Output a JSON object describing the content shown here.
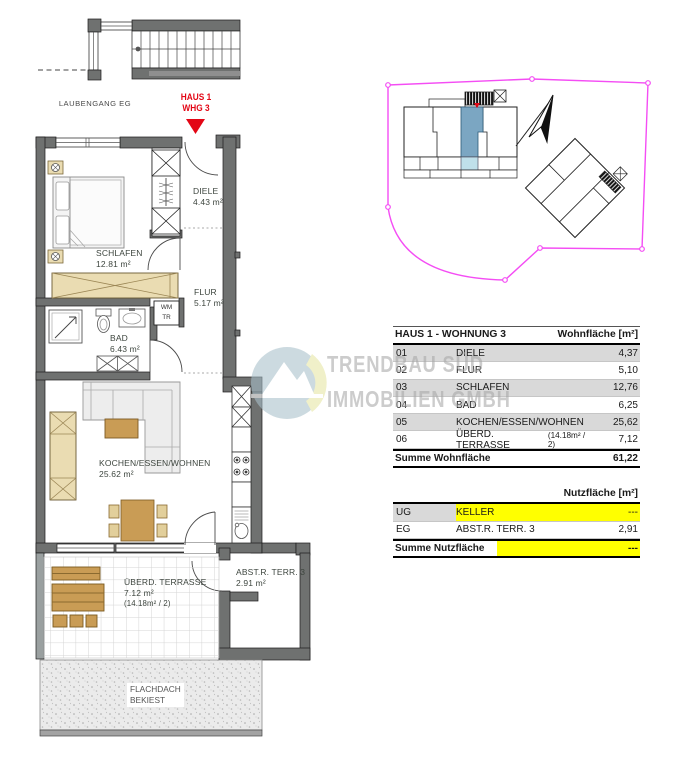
{
  "plan": {
    "corridor_label": "LAUBENGANG EG",
    "unit_marker": {
      "line1": "HAUS 1",
      "line2": "WHG 3"
    },
    "rooms": {
      "diele": {
        "name": "DIELE",
        "area": "4.43 m²"
      },
      "schlafen": {
        "name": "SCHLAFEN",
        "area": "12.81 m²"
      },
      "flur": {
        "name": "FLUR",
        "area": "5.17 m²"
      },
      "bad": {
        "name": "BAD",
        "area": "6.43 m²"
      },
      "wohnen": {
        "name": "KOCHEN/ESSEN/WOHNEN",
        "area": "25.62 m²"
      },
      "terrasse": {
        "name": "ÜBERD. TERRASSE",
        "area": "7.12 m²",
        "note": "(14.18m² / 2)"
      },
      "abstellraum": {
        "name": "ABST.R. TERR. 3",
        "area": "2.91 m²"
      },
      "flachdach": {
        "line1": "FLACHDACH",
        "line2": "BEKIEST"
      }
    },
    "appliance_labels": {
      "wm": "WM",
      "tr": "TR"
    }
  },
  "watermark": {
    "line1": "TRENDBAU SÜD",
    "line2": "IMMOBILIEN GMBH"
  },
  "tables": {
    "wohnflaeche": {
      "title": "HAUS 1 - WOHNUNG 3",
      "unit_header": "Wohnfläche [m²]",
      "rows": [
        {
          "nr": "01",
          "room": "DIELE",
          "value": "4,37"
        },
        {
          "nr": "02",
          "room": "FLUR",
          "value": "5,10"
        },
        {
          "nr": "03",
          "room": "SCHLAFEN",
          "value": "12,76"
        },
        {
          "nr": "04",
          "room": "BAD",
          "value": "6,25"
        },
        {
          "nr": "05",
          "room": "KOCHEN/ESSEN/WOHNEN",
          "value": "25,62"
        },
        {
          "nr": "06",
          "room": "ÜBERD. TERRASSE",
          "note": "(14.18m² / 2)",
          "value": "7,12"
        }
      ],
      "sum_label": "Summe Wohnfläche",
      "sum_value": "61,22"
    },
    "nutzflaeche": {
      "unit_header": "Nutzfläche [m²]",
      "rows": [
        {
          "nr": "UG",
          "room": "KELLER",
          "value": "---"
        },
        {
          "nr": "EG",
          "room": "ABST.R. TERR. 3",
          "value": "2,91"
        }
      ],
      "sum_label": "Summe Nutzfläche",
      "sum_value": "---"
    }
  },
  "colors": {
    "accent_red": "#e30615",
    "boundary_magenta": "#f44df4",
    "unit_highlight_blue": "#7ba6c2",
    "unit_highlight_light_blue": "#bfe0ea",
    "table_highlight_yellow": "#ffff00",
    "row_shade_gray": "#d9d9d9"
  }
}
